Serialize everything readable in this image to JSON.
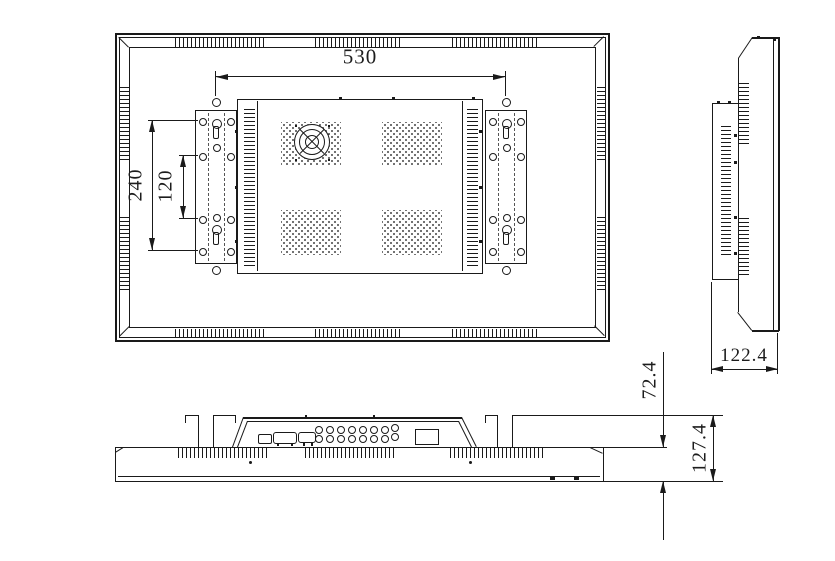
{
  "drawing": {
    "type": "monitor-mechanical-drawing",
    "background_color": "#ffffff",
    "line_color": "#1a1a1a",
    "dimensions": {
      "mount_width": "530",
      "mount_height_outer": "240",
      "mount_height_inner": "120",
      "side_depth": "122.4",
      "front_depth": "72.4",
      "total_depth": "127.4"
    }
  }
}
